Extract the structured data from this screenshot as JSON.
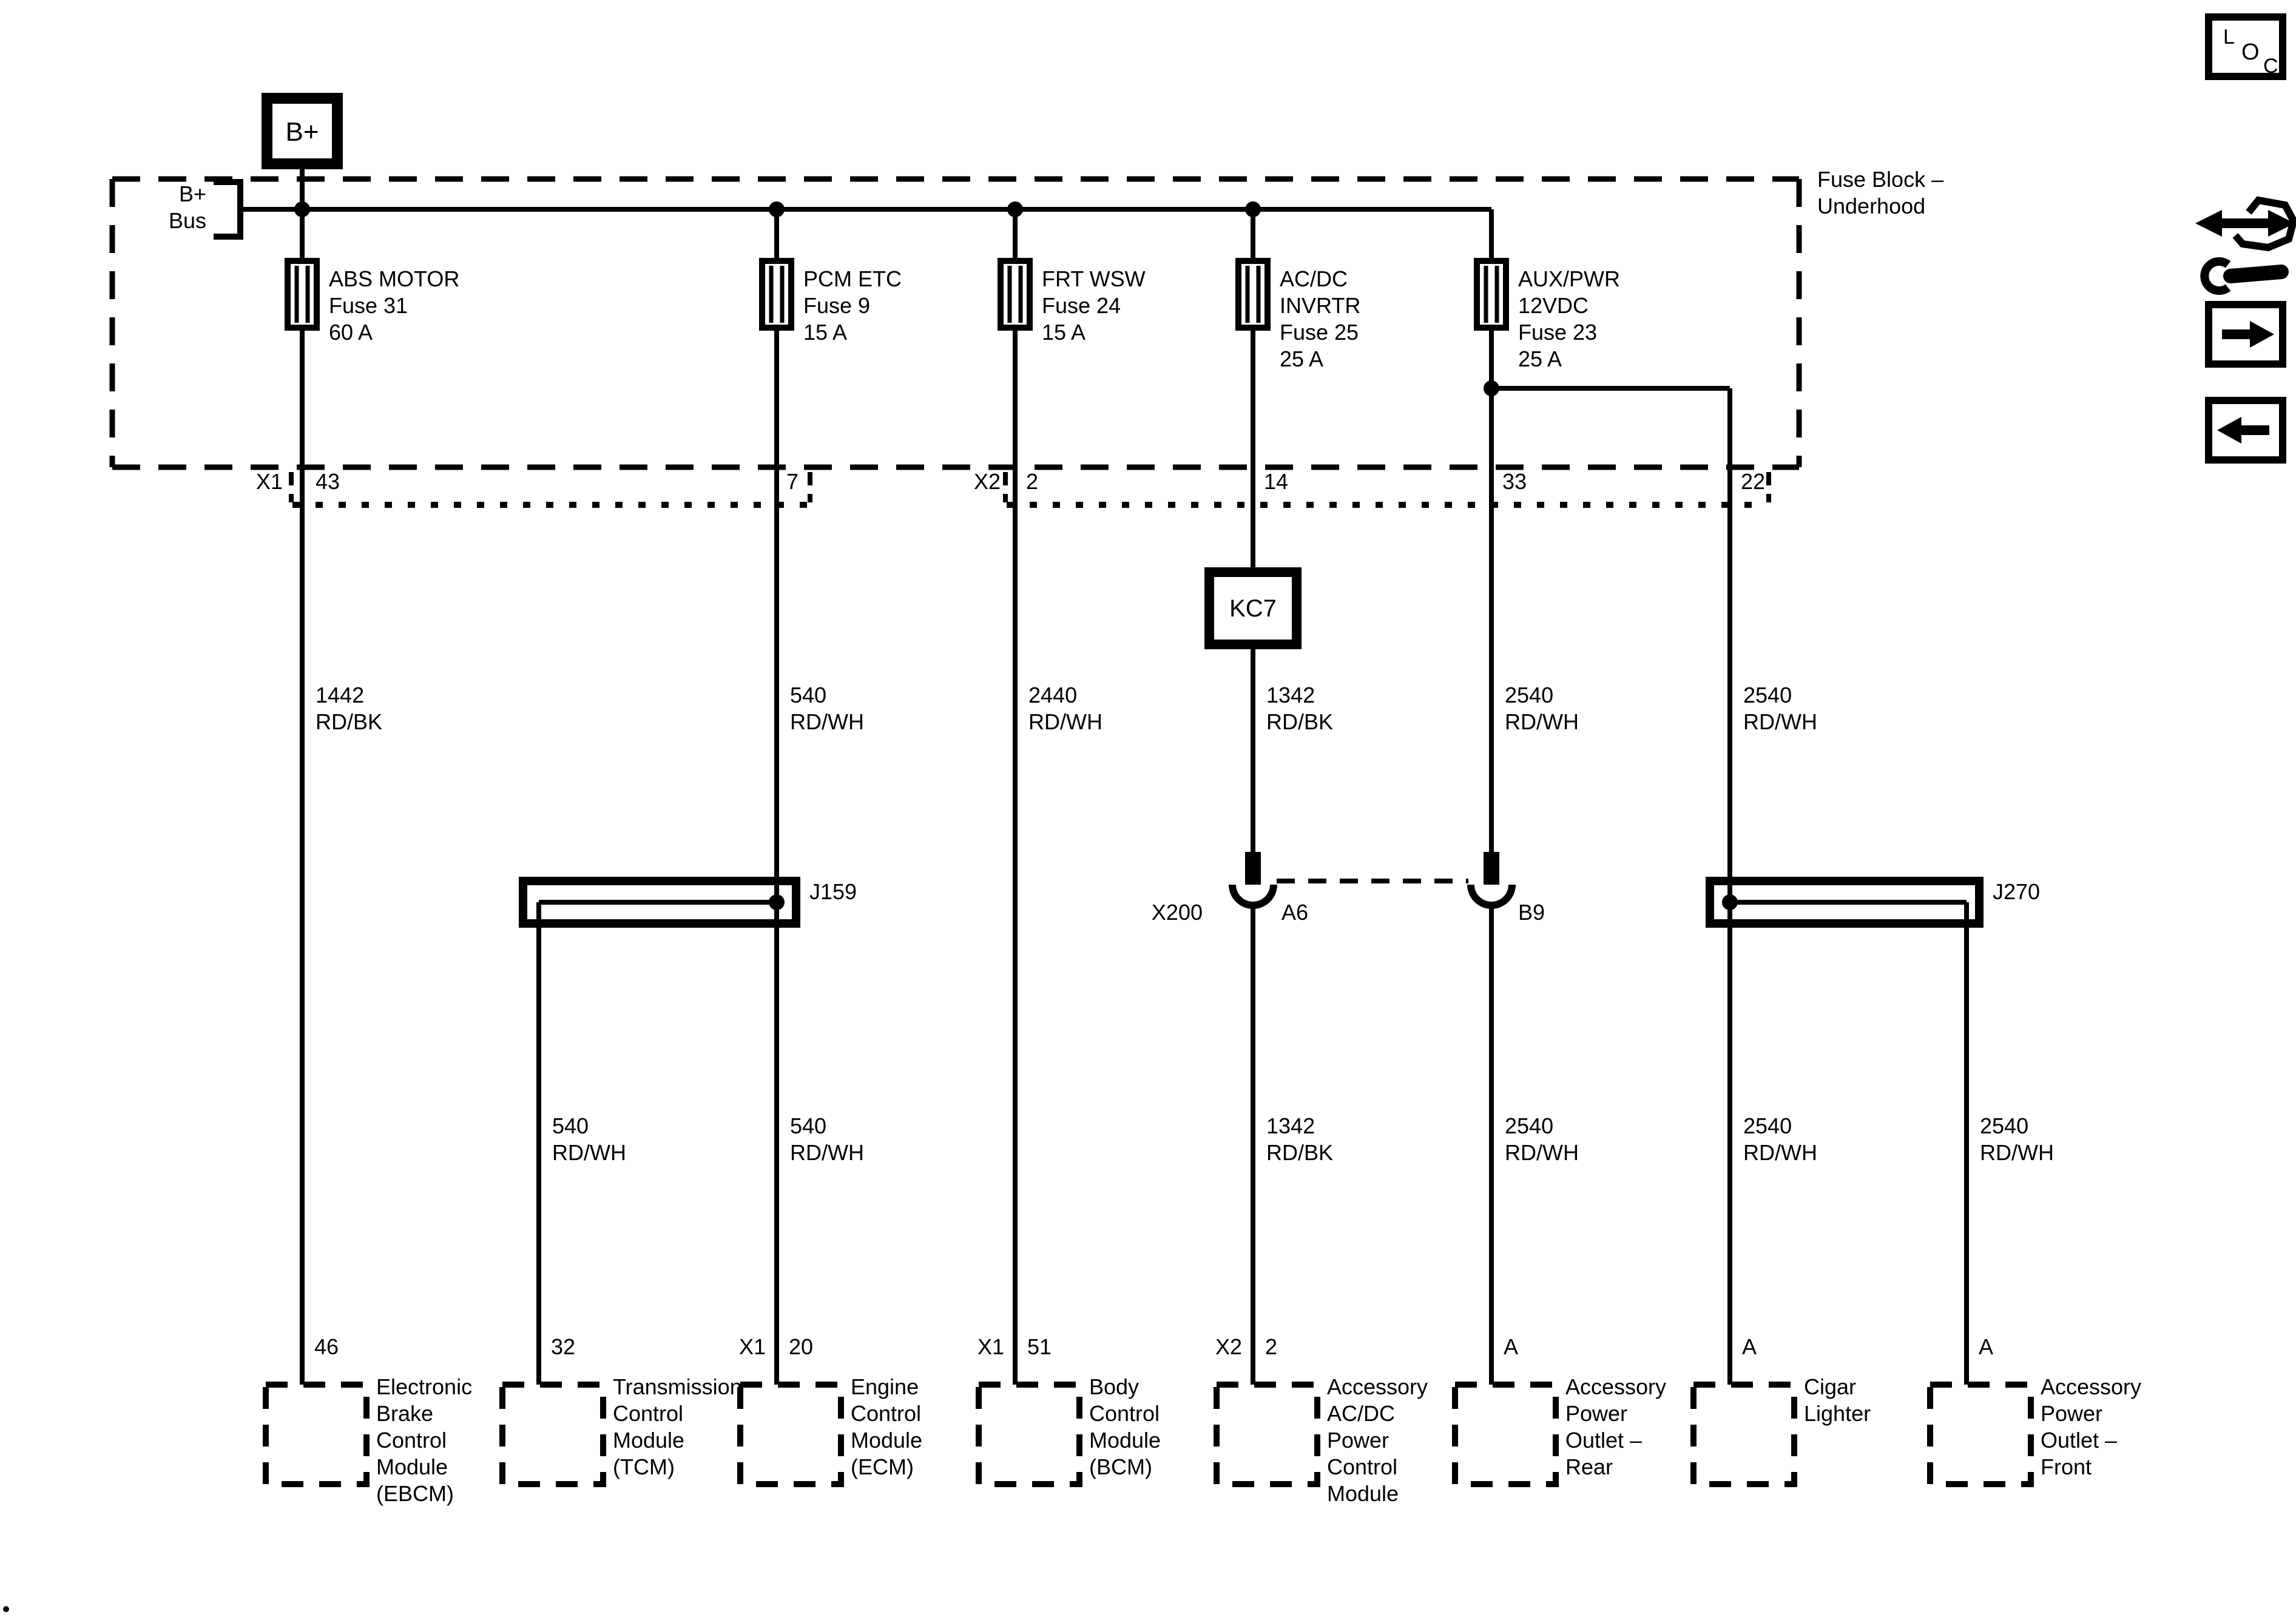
{
  "colors": {
    "ink": "#000000",
    "paper": "#ffffff"
  },
  "power": {
    "source_label": "B+",
    "bus_label": [
      "B+",
      "Bus"
    ]
  },
  "fuse_block": {
    "title": [
      "Fuse Block –",
      "Underhood"
    ],
    "connector_labels": {
      "x1": "X1",
      "x2": "X2"
    },
    "pins": [
      "43",
      "7",
      "2",
      "14",
      "33",
      "22"
    ]
  },
  "fuses": {
    "abs_motor": [
      "ABS MOTOR",
      "Fuse 31",
      "60 A"
    ],
    "pcm_etc": [
      "PCM ETC",
      "Fuse 9",
      "15 A"
    ],
    "frt_wsw": [
      "FRT WSW",
      "Fuse 24",
      "15 A"
    ],
    "acdc_invrtr": [
      "AC/DC",
      "INVRTR",
      "Fuse 25",
      "25 A"
    ],
    "aux_pwr": [
      "AUX/PWR",
      "12VDC",
      "Fuse 23",
      "25 A"
    ]
  },
  "relay_box": "KC7",
  "splices": {
    "j159": "J159",
    "j270": "J270"
  },
  "inline_connector": {
    "name": "X200",
    "pin_a": "A6",
    "pin_b": "B9"
  },
  "wire_labels": {
    "row1": [
      [
        "1442",
        "RD/BK"
      ],
      [
        "540",
        "RD/WH"
      ],
      [
        "2440",
        "RD/WH"
      ],
      [
        "1342",
        "RD/BK"
      ],
      [
        "2540",
        "RD/WH"
      ],
      [
        "2540",
        "RD/WH"
      ]
    ],
    "row2": [
      [
        "540",
        "RD/WH"
      ],
      [
        "540",
        "RD/WH"
      ],
      [
        "1342",
        "RD/BK"
      ],
      [
        "2540",
        "RD/WH"
      ],
      [
        "2540",
        "RD/WH"
      ],
      [
        "2540",
        "RD/WH"
      ]
    ]
  },
  "modules": [
    {
      "connector": "",
      "pin": "46",
      "name": [
        "Electronic",
        "Brake",
        "Control",
        "Module",
        "(EBCM)"
      ]
    },
    {
      "connector": "",
      "pin": "32",
      "name": [
        "Transmission",
        "Control",
        "Module",
        "(TCM)"
      ]
    },
    {
      "connector": "X1",
      "pin": "20",
      "name": [
        "Engine",
        "Control",
        "Module",
        "(ECM)"
      ]
    },
    {
      "connector": "X1",
      "pin": "51",
      "name": [
        "Body",
        "Control",
        "Module",
        "(BCM)"
      ]
    },
    {
      "connector": "X2",
      "pin": "2",
      "name": [
        "Accessory",
        "AC/DC",
        "Power",
        "Control",
        "Module"
      ]
    },
    {
      "connector": "",
      "pin": "A",
      "name": [
        "Accessory",
        "Power",
        "Outlet –",
        "Rear"
      ]
    },
    {
      "connector": "",
      "pin": "A",
      "name": [
        "Cigar",
        "Lighter"
      ]
    },
    {
      "connector": "",
      "pin": "A",
      "name": [
        "Accessory",
        "Power",
        "Outlet –",
        "Front"
      ]
    }
  ],
  "nav": {
    "loc_letters": [
      "L",
      "O",
      "C"
    ]
  }
}
